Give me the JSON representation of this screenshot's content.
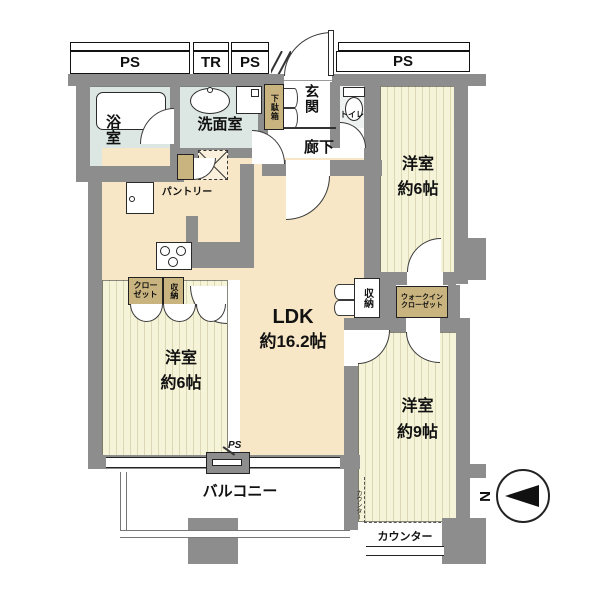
{
  "ducts": {
    "ps_left": "PS",
    "tr": "TR",
    "ps_mid": "PS",
    "ps_right": "PS",
    "ps_bottom": "PS"
  },
  "rooms": {
    "bath": {
      "name": "浴室"
    },
    "washroom": {
      "name": "洗面室"
    },
    "entrance": {
      "name": "玄関"
    },
    "shoe_cabinet": {
      "name": "下駄箱"
    },
    "toilet": {
      "name": "トイレ"
    },
    "hallway": {
      "name": "廊下"
    },
    "bedroom_ne": {
      "name": "洋室",
      "size": "約6帖"
    },
    "bedroom_west": {
      "name": "洋室",
      "size": "約6帖"
    },
    "bedroom_se": {
      "name": "洋室",
      "size": "約9帖"
    },
    "ldk": {
      "name": "LDK",
      "size": "約16.2帖"
    },
    "balcony": {
      "name": "バルコニー"
    }
  },
  "storage": {
    "pantry": "パントリー",
    "closet_line1": "クロー",
    "closet_line2": "ゼット",
    "storage_kitchen": "収納",
    "storage_hall": "収納",
    "walkin_line1": "ウォークイン",
    "walkin_line2": "クローゼット"
  },
  "counter": {
    "label": "カウンター",
    "label_vertical": "カウンター"
  },
  "compass": {
    "north": "N"
  },
  "colors": {
    "wall": "#8d8d8d",
    "ldk_floor": "#f8e7c6",
    "bedroom_floor": "#f5f3d8",
    "wet_floor": "#dce7e4",
    "storage_box": "#c9b37e"
  }
}
